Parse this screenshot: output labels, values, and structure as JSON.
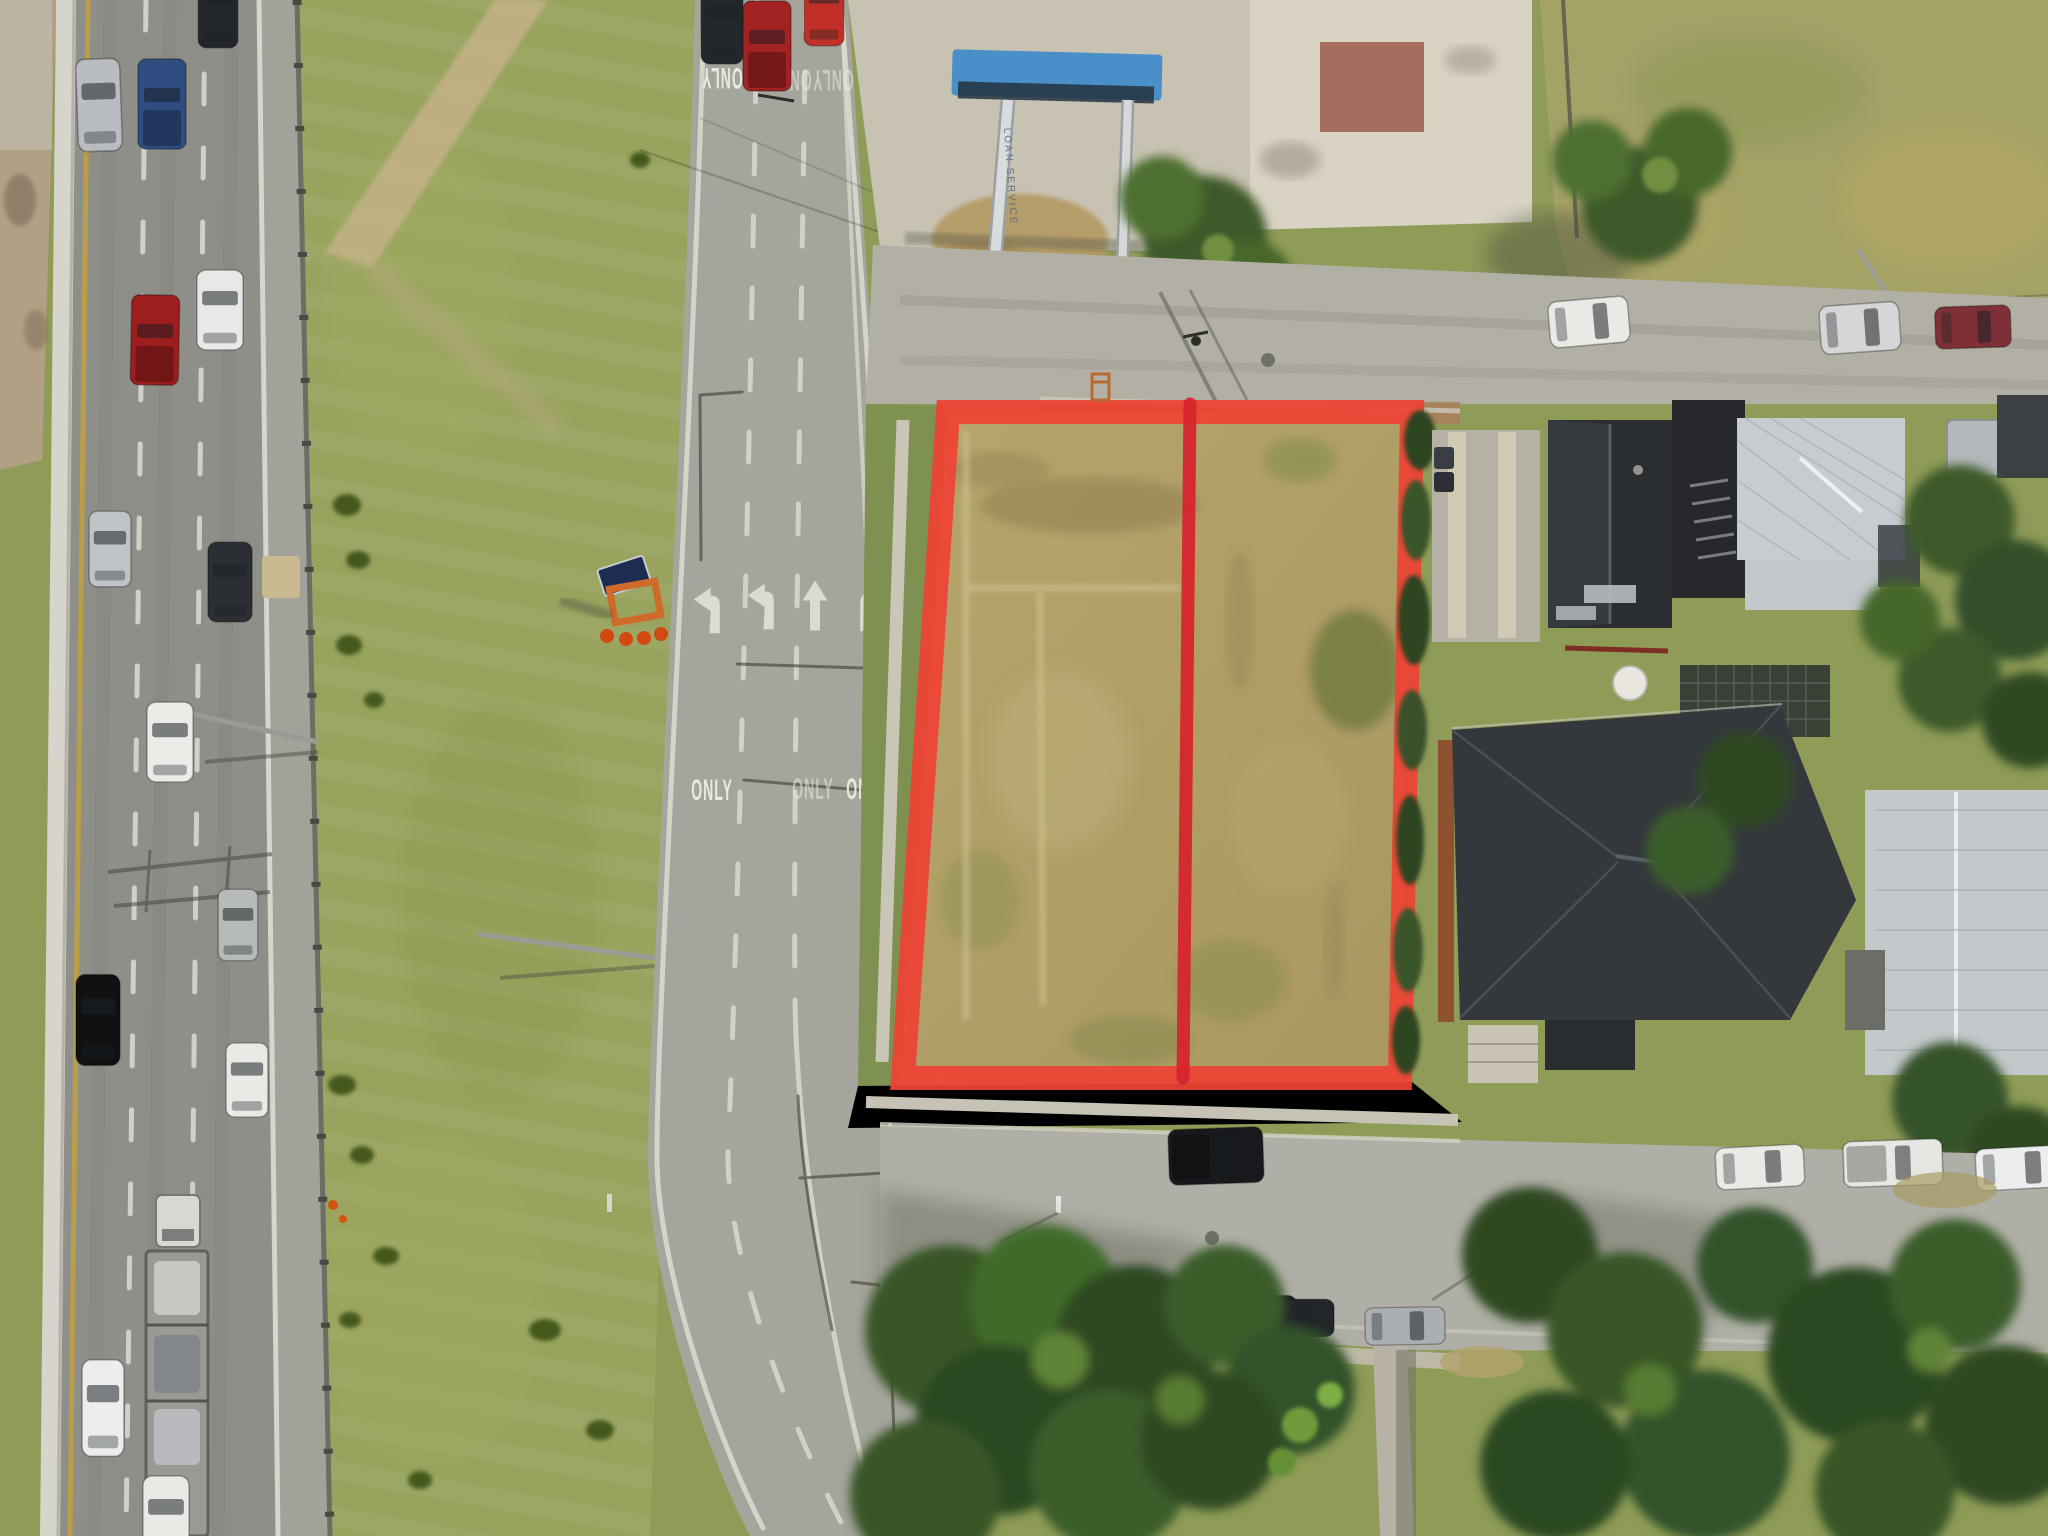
{
  "markings": {
    "only": "ONLY"
  },
  "pole_sign": {
    "text": "LOAN SERVICE"
  },
  "colors": {
    "outline_red": "#ee4334",
    "divider_red": "#d8232e",
    "canopy_blue": "#4a8fc7",
    "asphalt": "#8e8f88",
    "road_light": "#a5a59d",
    "concrete": "#c8c2b2",
    "lot_tan": "#b3a267",
    "median_grass": "#98a35e",
    "tree_green": "#3d5a2a",
    "grass_base": "#8f9c58"
  }
}
